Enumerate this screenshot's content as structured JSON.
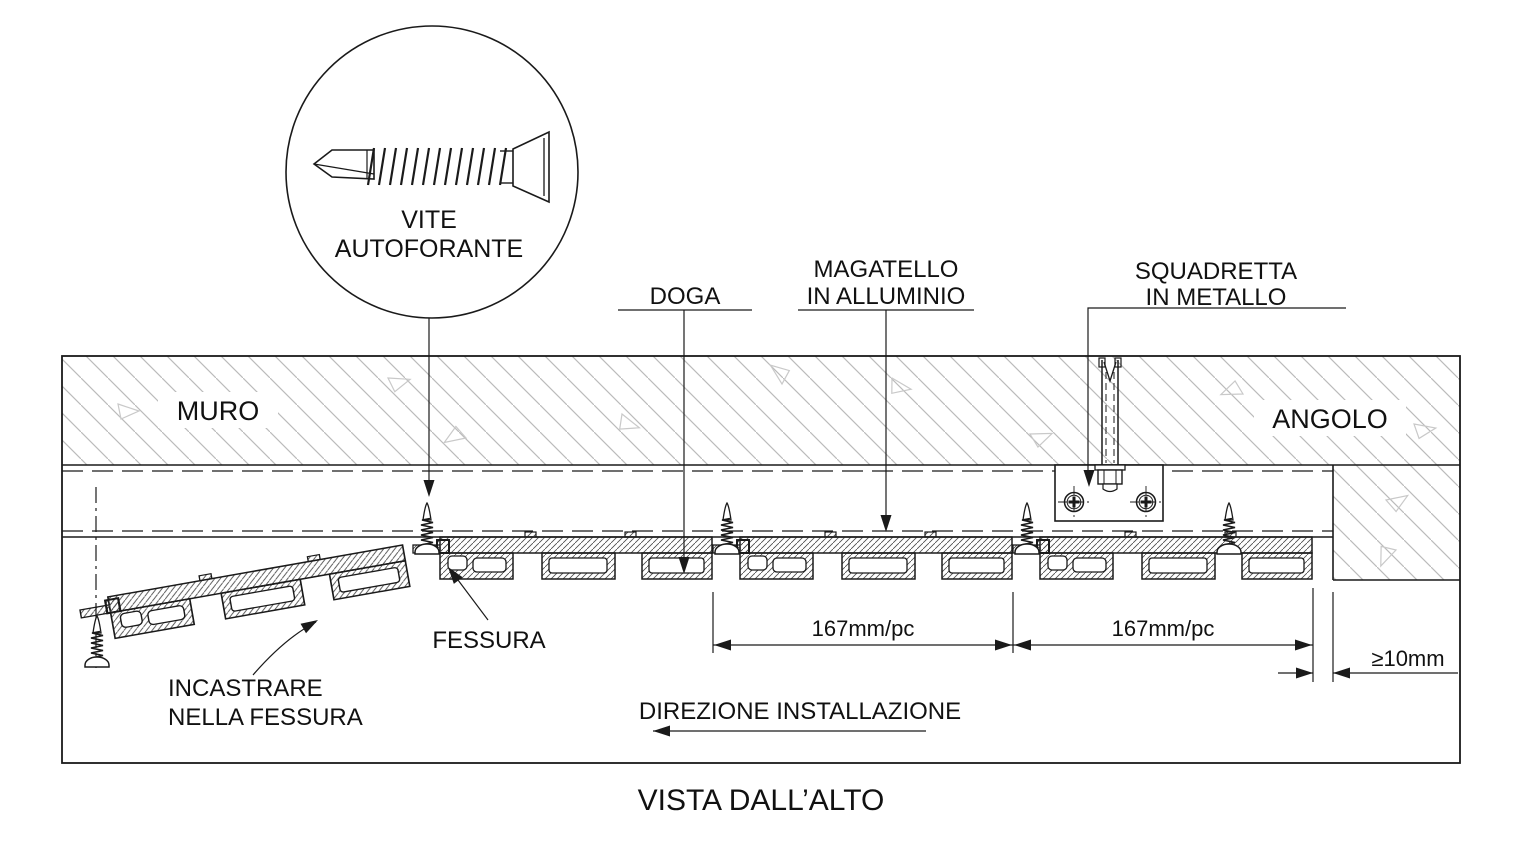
{
  "drawing": {
    "title": "VISTA DALL’ALTO",
    "detail_circle": {
      "label_line1": "VITE",
      "label_line2": "AUTOFORANTE"
    },
    "labels": {
      "wall": "MURO",
      "corner": "ANGOLO",
      "slat": "DOGA",
      "batten_line1": "MAGATELLO",
      "batten_line2": "IN ALLUMINIO",
      "bracket_line1": "SQUADRETTA",
      "bracket_line2": "IN METALLO",
      "slot": "FESSURA",
      "insert_line1": "INCASTRARE",
      "insert_line2": "NELLA FESSURA",
      "direction": "DIREZIONE INSTALLAZIONE"
    },
    "dimensions": {
      "module1": "167mm/pc",
      "module2": "167mm/pc",
      "edge_gap": "≥10mm"
    },
    "colors": {
      "line": "#1a1a1a",
      "text": "#111111",
      "wall_hatch": "#bbbbbb",
      "aggregate_triangles": "#c9c9c9",
      "aluminium_hatch": "#4a4a4a",
      "background": "#ffffff"
    }
  }
}
